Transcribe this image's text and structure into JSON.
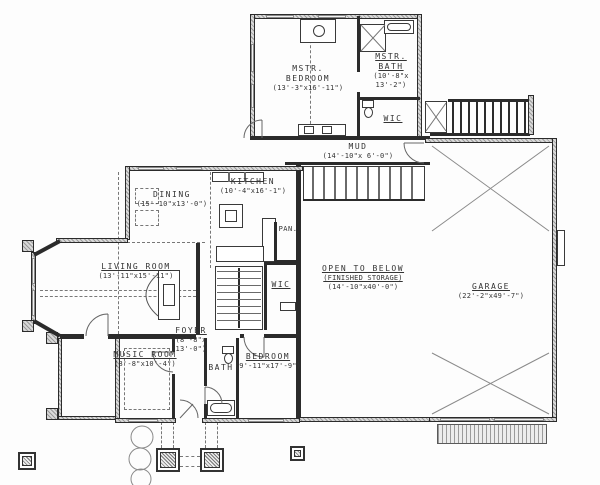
{
  "rooms": {
    "mstr_bedroom": {
      "name": "MSTR. BEDROOM",
      "dims": "(13'-3\"x16'-11\")"
    },
    "mstr_bath": {
      "name": "MSTR. BATH",
      "dims": "(10'-8\"x 13'-2\")"
    },
    "mstr_wic": {
      "name": "WIC"
    },
    "mud": {
      "name": "MUD",
      "dims": "(14'-10\"x 6'-0\")"
    },
    "kitchen": {
      "name": "KITCHEN",
      "dims": "(10'-4\"x16'-1\")"
    },
    "pantry": {
      "name": "PAN."
    },
    "dining": {
      "name": "DINING",
      "dims": "(15'-10\"x13'-0\")"
    },
    "living_room": {
      "name": "LIVING ROOM",
      "dims": "(13'-11\"x15'-11\")"
    },
    "open_to_below": {
      "name": "OPEN TO BELOW",
      "sub": "(FINISHED STORAGE)",
      "dims": "(14'-10\"x40'-0\")"
    },
    "garage": {
      "name": "GARAGE",
      "dims": "(22'-2\"x49'-7\")"
    },
    "foyer": {
      "name": "FOYER",
      "dims": "(8'-8\"x 13'-0\")"
    },
    "hall_wic": {
      "name": "WIC"
    },
    "music_room": {
      "name": "MUSIC ROOM",
      "dims": "(8'-8\"x10'-4\")"
    },
    "bath": {
      "name": "BATH"
    },
    "bedroom": {
      "name": "BEDROOM",
      "dims": "(9'-11\"x17'-9\")"
    }
  }
}
